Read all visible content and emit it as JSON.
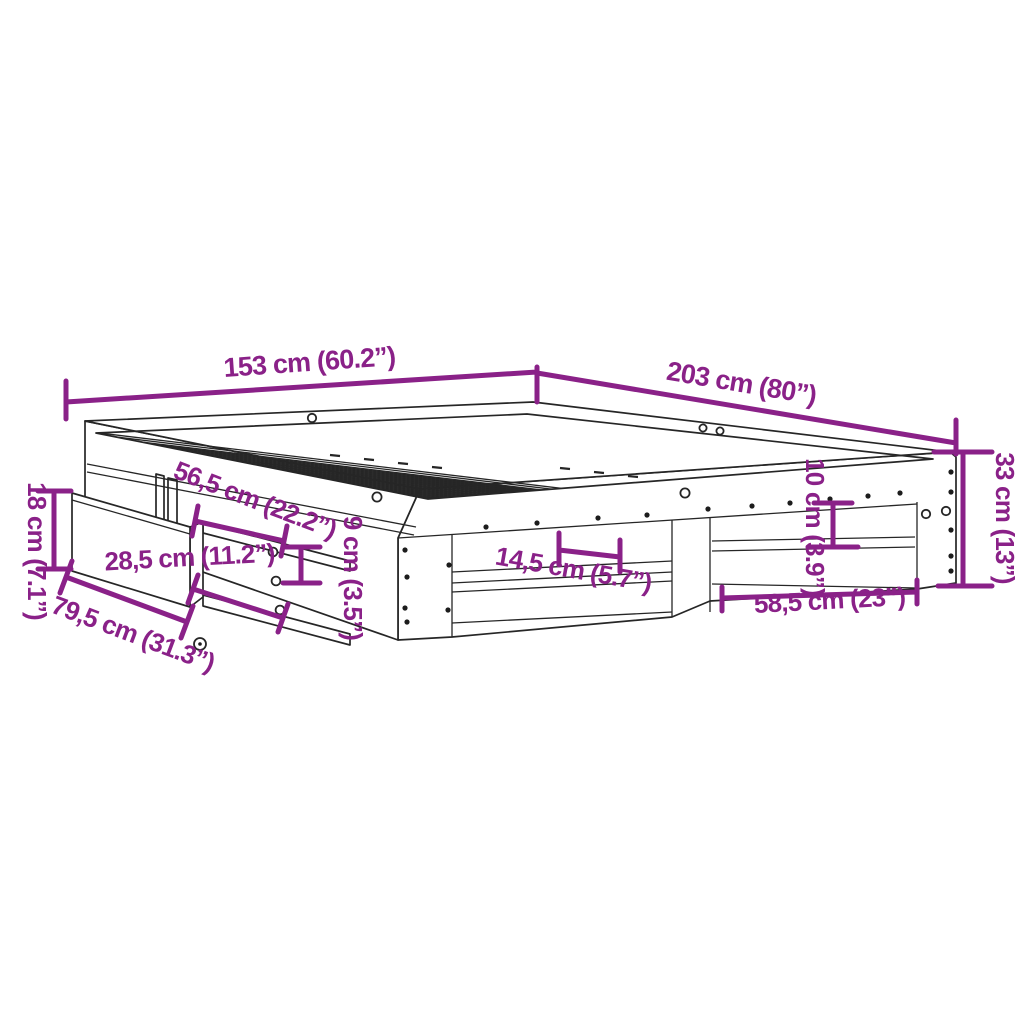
{
  "diagram": {
    "name": "Bed frame with drawer dimension diagram",
    "background": "#ffffff",
    "accent_color": "#8A2188",
    "outline_color": "#262626"
  },
  "labels": {
    "top_width": "153 cm (60.2”)",
    "top_length": "203 cm (80”)",
    "right_height": "33 cm (13”)",
    "left_height": "18 cm (7.1”)",
    "under_bed_depth": "79,5 cm (31.3”)",
    "drawer_slide_length": "56,5 cm (22.2”)",
    "side_rail_height": "9 cm (3.5”)",
    "drawer_front_height": "28,5 cm (11.2”)",
    "slat_shelf_gap": "14,5 cm (5.7”)",
    "shelf_opening_height": "10 cm (3.9”)",
    "shelf_opening_width": "58,5 cm (23”)"
  }
}
